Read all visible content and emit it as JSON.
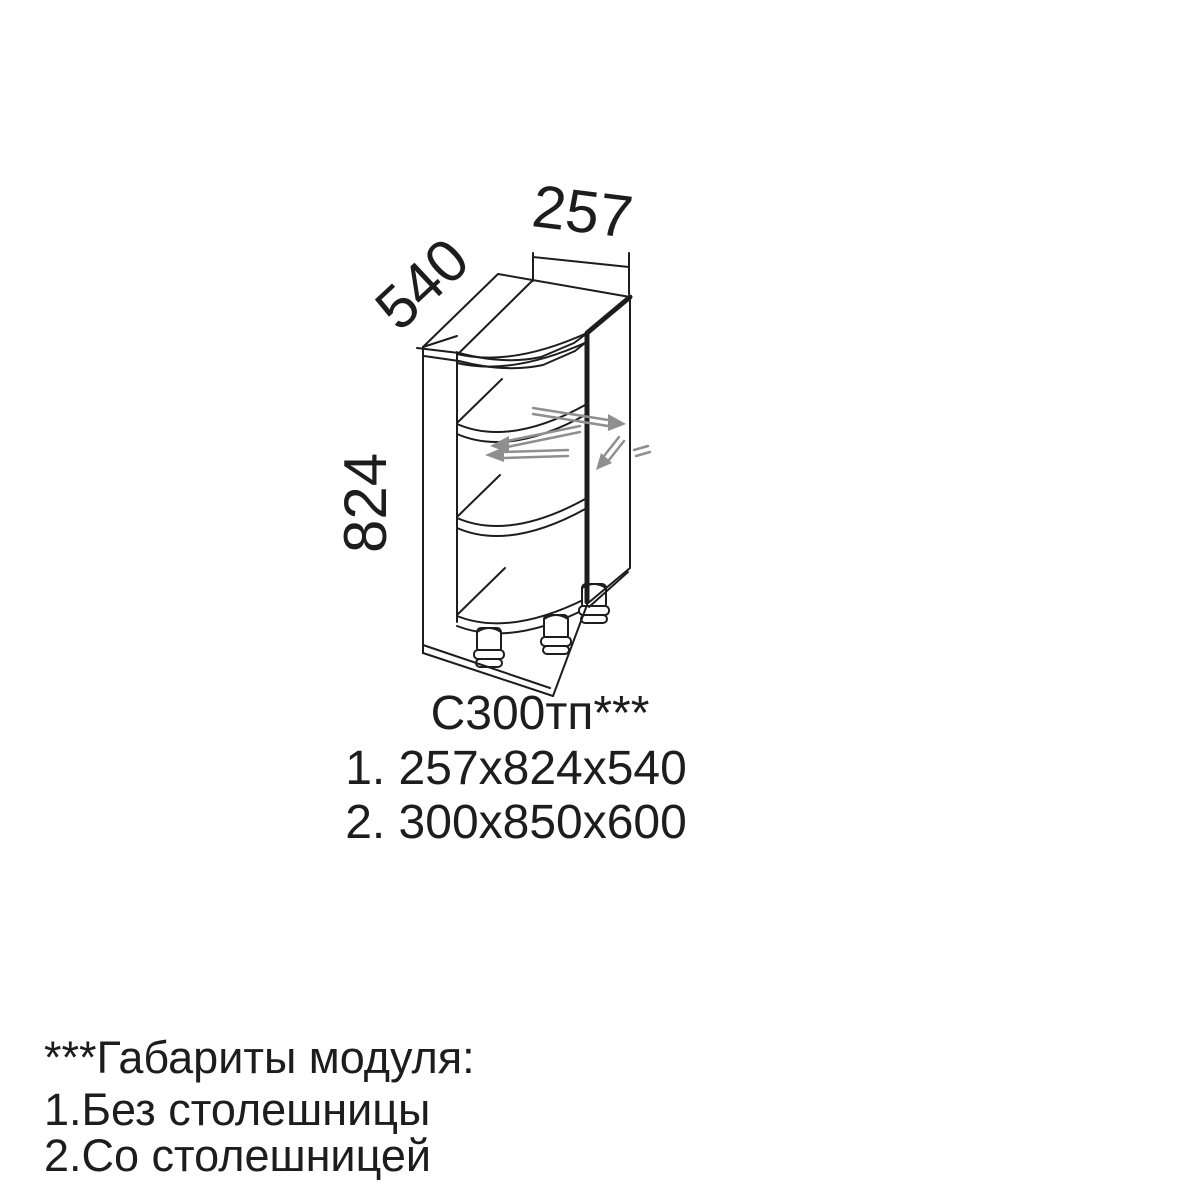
{
  "dimensions": {
    "width": "257",
    "depth": "540",
    "height": "824"
  },
  "caption": {
    "model": "С300тп***",
    "options": [
      "1. 257x824x540",
      "2. 300x850x600"
    ]
  },
  "footnote": {
    "title": "***Габариты модуля:",
    "items": [
      "1.Без столешницы",
      "2.Со столешницей"
    ]
  },
  "colors": {
    "line": "#1d1d1d",
    "arrow": "#8f8f8f",
    "background": "#ffffff"
  }
}
